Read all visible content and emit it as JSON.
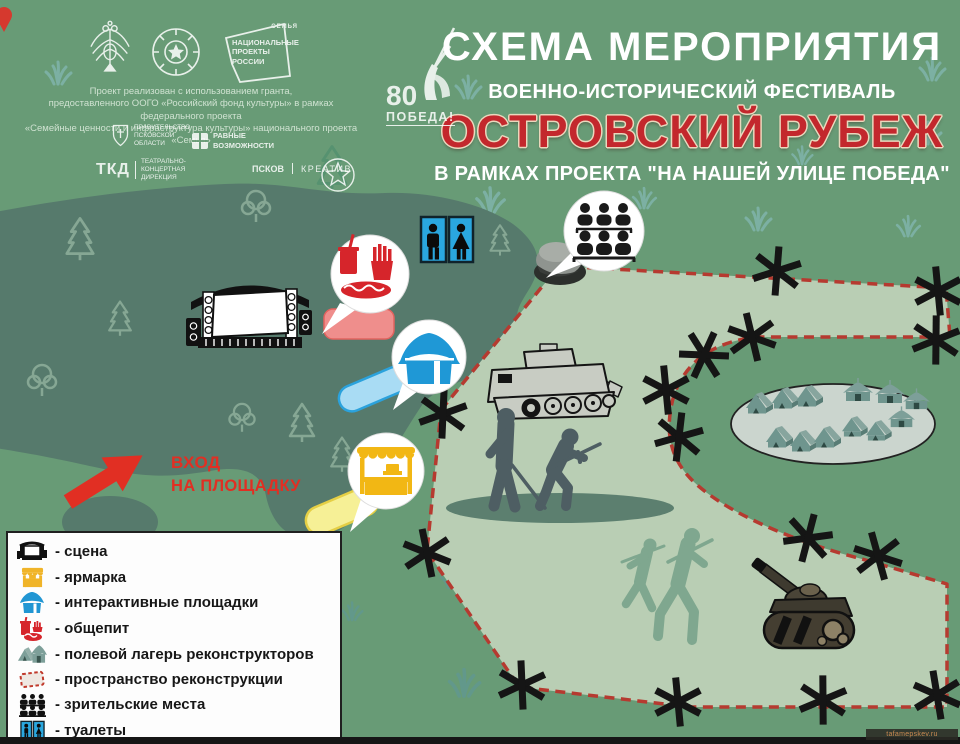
{
  "poster": {
    "title": "СХЕМА МЕРОПРИЯТИЯ",
    "subtitle": "ВОЕННО-ИСТОРИЧЕСКИЙ ФЕСТИВАЛЬ",
    "event_name": "ОСТРОВСКИЙ РУБЕЖ",
    "project_line": "В РАМКАХ ПРОЕКТА  \"НА НАШЕЙ УЛИЦЕ ПОБЕДА\"",
    "grant_lines": [
      "Проект реализован с использованием гранта,",
      "предоставленного ООГО «Российский фонд культуры» в рамках федерального проекта",
      "«Семейные ценности и инфраструктура культуры» национального проекта «Семья»"
    ]
  },
  "logos": {
    "national_projects": {
      "lines": [
        "НАЦИОНАЛЬНЫЕ",
        "ПРОЕКТЫ",
        "РОССИИ"
      ],
      "tag": "СЕМЬЯ"
    },
    "victory_80": {
      "number": "80",
      "label": "ПОБЕДА!"
    },
    "pskov_government": {
      "lines": [
        "ПРАВИТЕЛЬСТВО",
        "ПСКОВСКОЙ",
        "ОБЛАСТИ"
      ]
    },
    "equal_opportunities": {
      "lines": [
        "РАВНЫЕ",
        "ВОЗМОЖНОСТИ"
      ]
    },
    "theatre_concert_directorate": {
      "abbr": "ТКД",
      "lines": [
        "ТЕАТРАЛЬНО-",
        "КОНЦЕРТНАЯ",
        "ДИРЕКЦИЯ"
      ]
    },
    "pskov_creative": {
      "part1": "ПСКОВ",
      "part2": "КРЕАТИВ"
    }
  },
  "map": {
    "entrance": {
      "line1": "ВХОД",
      "line2": "НА ПЛОЩАДКУ"
    }
  },
  "legend": {
    "items": [
      {
        "id": "stage",
        "label": "- сцена"
      },
      {
        "id": "fair",
        "label": "- ярмарка"
      },
      {
        "id": "interactive",
        "label": "- интерактивные площадки"
      },
      {
        "id": "food",
        "label": "- общепит"
      },
      {
        "id": "camp",
        "label": "- полевой лагерь реконструкторов"
      },
      {
        "id": "reconstruction",
        "label": "- пространство реконструкции"
      },
      {
        "id": "audience",
        "label": "- зрительские места"
      },
      {
        "id": "wc",
        "label": "- туалеты"
      }
    ]
  },
  "watermark": {
    "text": "tafamepskev.ru"
  },
  "colors": {
    "background_green": "#689b76",
    "forest_green": "#567a6c",
    "field_light": "#b9ceb4",
    "boundary_red": "#b63a30",
    "accent_red": "#c3282d",
    "entrance_red": "#e12f23",
    "fair_yellow": "#f2b714",
    "interactive_blue": "#1f98d6",
    "food_red": "#d6252b",
    "wc_blue": "#2aa7df"
  }
}
